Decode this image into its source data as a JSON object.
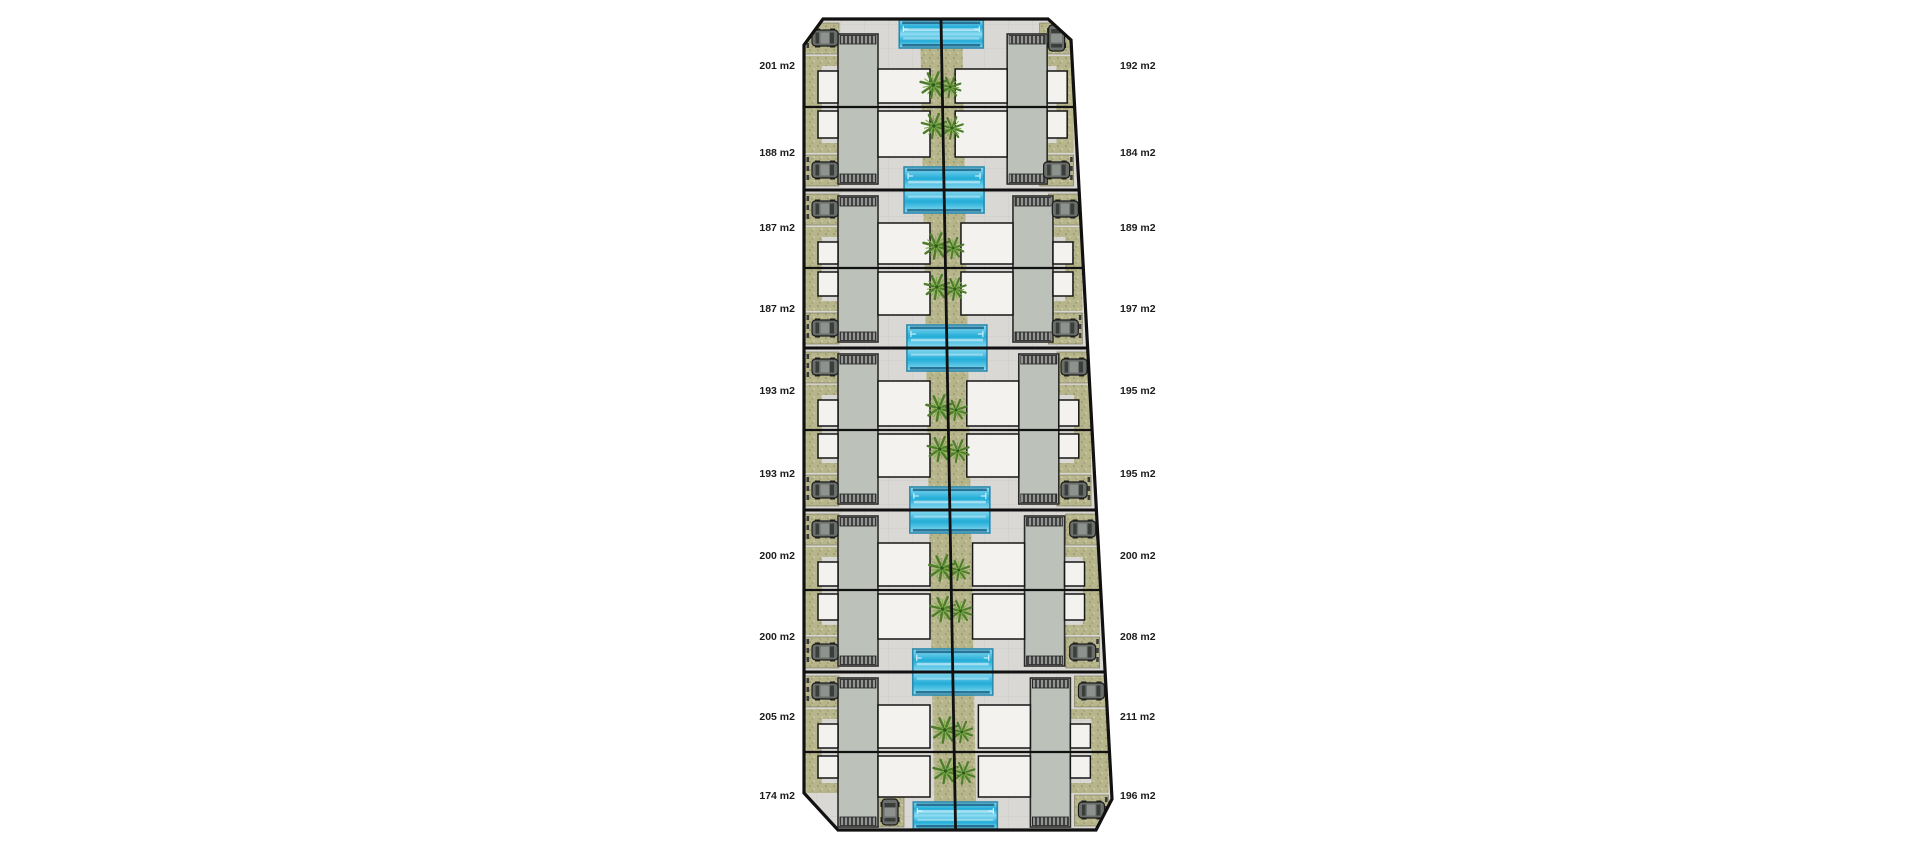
{
  "page": {
    "background": "#ffffff",
    "description": "residential development site plan with 20 villa plots"
  },
  "plan": {
    "unit": "m2",
    "left_areas": [
      "201 m2",
      "188 m2",
      "187 m2",
      "187 m2",
      "193 m2",
      "193 m2",
      "200 m2",
      "200 m2",
      "205 m2",
      "174 m2"
    ],
    "right_areas": [
      "192 m2",
      "184 m2",
      "189 m2",
      "197 m2",
      "195 m2",
      "195 m2",
      "200 m2",
      "208 m2",
      "211 m2",
      "196 m2"
    ],
    "icons": [
      "car-icon",
      "palm-tree-icon",
      "swimming-pool-icon",
      "house-roof",
      "terrace-steps",
      "parking-pad"
    ],
    "colors": {
      "background": "#ffffff",
      "paving": "#d9d8d4",
      "paving_line": "#cdccc8",
      "gravel": "#b7b58c",
      "gravel_dark": "#93915f",
      "gravel_light": "#d9d7b2",
      "roof": "#bcc2b9",
      "roof_edge": "#2b2b2b",
      "terrace": "#3f423f",
      "terrace_line": "#d8d8d8",
      "room": "#f3f2ee",
      "outline": "#161616",
      "pool_light": "#8edcf2",
      "pool_mid": "#23add8",
      "pool_edge": "#2d89ad",
      "pool_rail": "#1f6486",
      "palm_dark": "#4e7d2c",
      "palm_light": "#7fae4a",
      "car_body": "#6b6f6b",
      "car_glass": "#3a3e3a",
      "car_roof": "#8e928e",
      "hedge": "#3b3b3b",
      "label": "#1c1c1c"
    }
  }
}
